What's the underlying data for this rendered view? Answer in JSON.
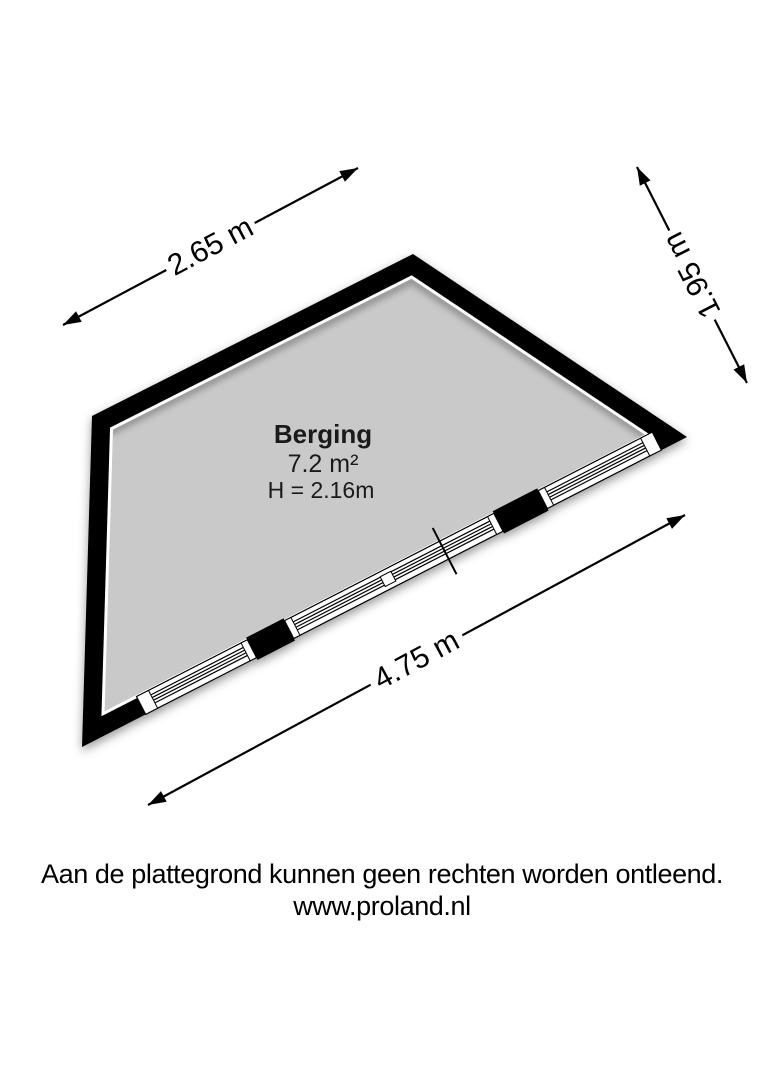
{
  "plan": {
    "room": {
      "name": "Berging",
      "area": "7.2 m²",
      "ceiling_height": "H = 2.16m"
    },
    "dimensions": {
      "top_left": "2.65 m",
      "right": "1.95 m",
      "bottom": "4.75 m"
    },
    "colors": {
      "wall": "#000000",
      "floor": "#c9c9c9",
      "window": "#ffffff",
      "background": "#ffffff",
      "dimension_line": "#000000"
    }
  },
  "footer": {
    "disclaimer": "Aan de plattegrond kunnen geen rechten worden ontleend.",
    "website": "www.proland.nl"
  }
}
